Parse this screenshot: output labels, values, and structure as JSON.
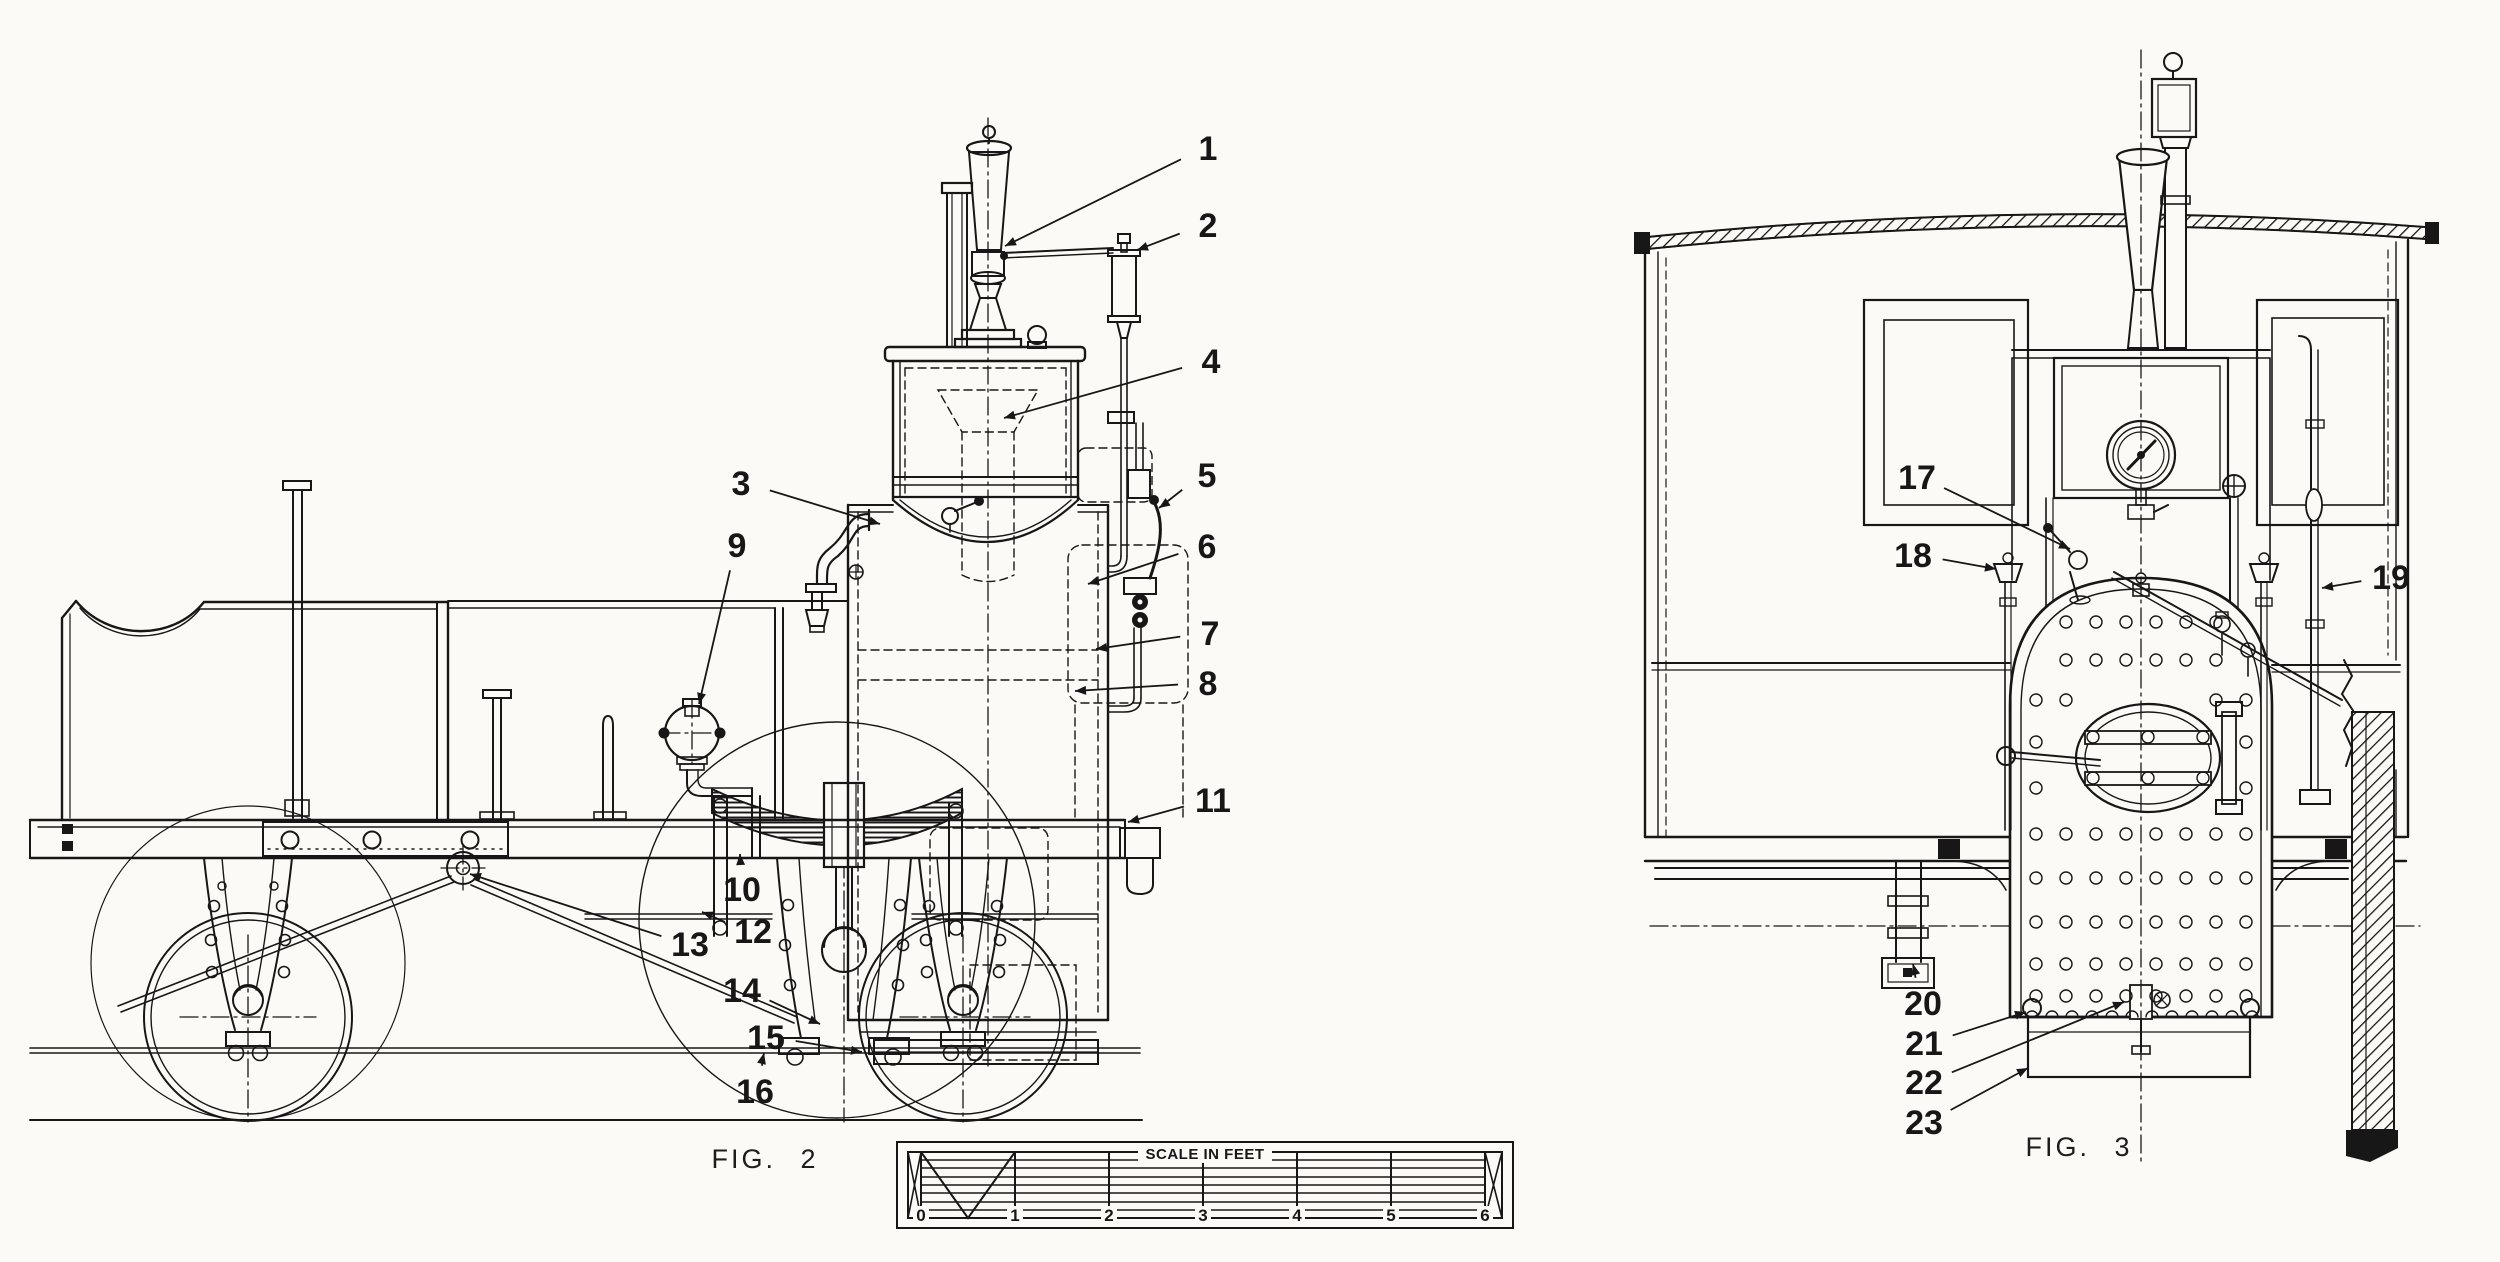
{
  "document": {
    "kind_visible_text_only": true
  },
  "colors": {
    "paper": "#fbfaf6",
    "ink": "#171717"
  },
  "figures": [
    {
      "id": "fig2",
      "label": "FIG.  2",
      "callouts": [
        {
          "n": "1",
          "lx": 1208,
          "ly": 148,
          "tx": 1005,
          "ty": 246
        },
        {
          "n": "2",
          "lx": 1208,
          "ly": 225,
          "tx": 1137,
          "ty": 250
        },
        {
          "n": "3",
          "lx": 741,
          "ly": 483,
          "tx": 880,
          "ty": 524
        },
        {
          "n": "4",
          "lx": 1211,
          "ly": 361,
          "tx": 1004,
          "ty": 418
        },
        {
          "n": "5",
          "lx": 1207,
          "ly": 475,
          "tx": 1159,
          "ty": 508
        },
        {
          "n": "6",
          "lx": 1207,
          "ly": 546,
          "tx": 1088,
          "ty": 584
        },
        {
          "n": "7",
          "lx": 1210,
          "ly": 633,
          "tx": 1096,
          "ty": 649
        },
        {
          "n": "8",
          "lx": 1208,
          "ly": 683,
          "tx": 1075,
          "ty": 691
        },
        {
          "n": "9",
          "lx": 737,
          "ly": 545,
          "tx": 699,
          "ty": 704
        },
        {
          "n": "10",
          "lx": 742,
          "ly": 889,
          "tx": 740,
          "ty": 854
        },
        {
          "n": "11",
          "lx": 1213,
          "ly": 800,
          "tx": 1128,
          "ty": 822
        },
        {
          "n": "12",
          "lx": 753,
          "ly": 931,
          "tx": 702,
          "ty": 912
        },
        {
          "n": "13",
          "lx": 690,
          "ly": 944,
          "tx": 470,
          "ty": 874
        },
        {
          "n": "14",
          "lx": 742,
          "ly": 990,
          "tx": 820,
          "ty": 1024
        },
        {
          "n": "15",
          "lx": 766,
          "ly": 1037,
          "tx": 862,
          "ty": 1052
        },
        {
          "n": "16",
          "lx": 755,
          "ly": 1091,
          "tx": 764,
          "ty": 1053
        }
      ]
    },
    {
      "id": "fig3",
      "label": "FIG. 3",
      "callouts": [
        {
          "n": "17",
          "lx": 1917,
          "ly": 477,
          "tx": 2070,
          "ty": 549
        },
        {
          "n": "18",
          "lx": 1913,
          "ly": 555,
          "tx": 1996,
          "ty": 569
        },
        {
          "n": "19",
          "lx": 2391,
          "ly": 577,
          "tx": 2322,
          "ty": 588
        },
        {
          "n": "20",
          "lx": 1923,
          "ly": 1003,
          "tx": 1913,
          "ty": 964
        },
        {
          "n": "21",
          "lx": 1924,
          "ly": 1043,
          "tx": 2026,
          "ty": 1012
        },
        {
          "n": "22",
          "lx": 1924,
          "ly": 1082,
          "tx": 2124,
          "ty": 1002
        },
        {
          "n": "23",
          "lx": 1924,
          "ly": 1122,
          "tx": 2028,
          "ty": 1068
        }
      ]
    }
  ],
  "scale_bar": {
    "title": "SCALE IN FEET",
    "ticks": [
      "0",
      "1",
      "2",
      "3",
      "4",
      "5",
      "6"
    ]
  }
}
